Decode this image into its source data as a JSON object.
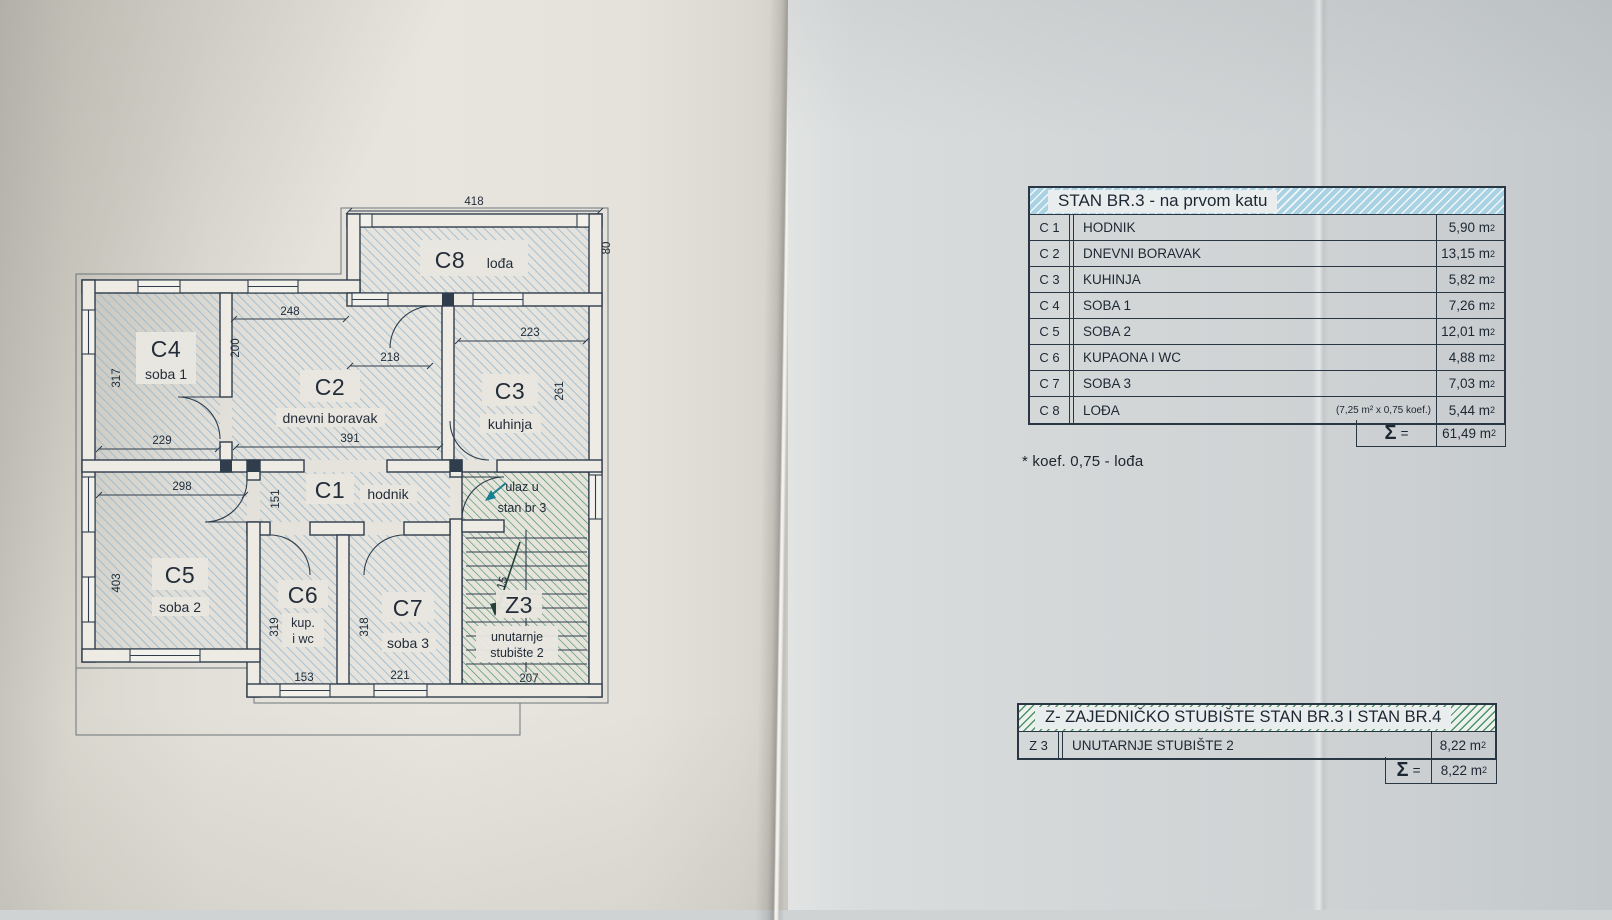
{
  "plan": {
    "rooms": {
      "c8": {
        "code": "C8",
        "name": "lođa"
      },
      "c4": {
        "code": "C4",
        "name": "soba 1"
      },
      "c2": {
        "code": "C2",
        "name": "dnevni boravak"
      },
      "c3": {
        "code": "C3",
        "name": "kuhinja"
      },
      "c1": {
        "code": "C1",
        "name": "hodnik"
      },
      "c5": {
        "code": "C5",
        "name": "soba 2"
      },
      "c6": {
        "code": "C6",
        "name_line1": "kup.",
        "name_line2": "i wc"
      },
      "c7": {
        "code": "C7",
        "name": "soba 3"
      },
      "z3": {
        "code": "Z3",
        "name_line1": "unutarnje",
        "name_line2": "stubište 2"
      }
    },
    "entry": {
      "line1": "ulaz u",
      "line2": "stan br 3"
    },
    "stair_note": "15",
    "dims": {
      "c8_width": "418",
      "c8_depth": "80",
      "c2_top": "248",
      "c4_door": "200",
      "c4_depth": "317",
      "c4_width": "229",
      "c2_mid": "218",
      "c2_width": "391",
      "c3_width": "223",
      "c3_depth": "261",
      "c5_width": "298",
      "c1_depth": "151",
      "c5_depth": "403",
      "c6_depth": "319",
      "c6_width": "153",
      "c7_depth": "318",
      "c7_width": "221",
      "z3_width": "207"
    }
  },
  "tables": {
    "unit": "m",
    "unit_sup": "2",
    "apartment": {
      "title": "STAN BR.3 - na prvom katu",
      "rows": [
        {
          "code": "C 1",
          "name": "HODNIK",
          "note": "",
          "area": "5,90"
        },
        {
          "code": "C 2",
          "name": "DNEVNI BORAVAK",
          "note": "",
          "area": "13,15"
        },
        {
          "code": "C 3",
          "name": "KUHINJA",
          "note": "",
          "area": "5,82"
        },
        {
          "code": "C 4",
          "name": "SOBA 1",
          "note": "",
          "area": "7,26"
        },
        {
          "code": "C 5",
          "name": "SOBA 2",
          "note": "",
          "area": "12,01"
        },
        {
          "code": "C 6",
          "name": "KUPAONA I WC",
          "note": "",
          "area": "4,88"
        },
        {
          "code": "C 7",
          "name": "SOBA 3",
          "note": "",
          "area": "7,03"
        },
        {
          "code": "C 8",
          "name": "LOĐA",
          "note": "(7,25 m² x 0,75 koef.)",
          "area": "5,44"
        }
      ],
      "sigma": "Σ",
      "eq": "=",
      "total": "61,49"
    },
    "note": "* koef. 0,75 - lođa",
    "staircase": {
      "title": "Z- ZAJEDNIČKO STUBIŠTE STAN BR.3 I STAN BR.4",
      "rows": [
        {
          "code": "Z 3",
          "name": "UNUTARNJE STUBIŠTE 2",
          "note": "",
          "area": "8,22"
        }
      ],
      "sigma": "Σ",
      "eq": "=",
      "total": "8,22"
    }
  }
}
